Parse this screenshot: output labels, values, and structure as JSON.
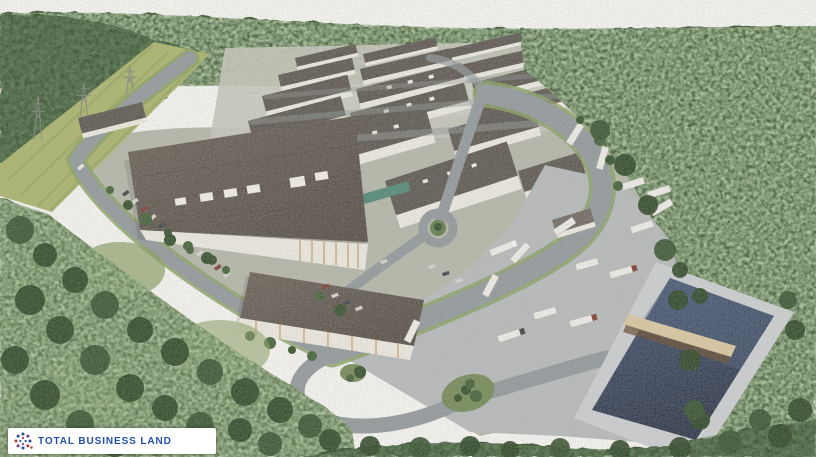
{
  "logo": {
    "text": "TOTAL BUSINESS LAND",
    "icon": "dotted-circle-logo-icon",
    "text_color": "#2450a8",
    "background": "#ffffff"
  },
  "scene": {
    "type": "aerial-architectural-rendering-of-industrial-business-park",
    "palette": {
      "sky": "#fbfbf8",
      "forest_dark": "#2e4a28",
      "forest_mid": "#3d5c33",
      "meadow": "#a9b469",
      "grass": "#6f8752",
      "road": "#8f979c",
      "apron": "#b7bbbe",
      "roof_dark": "#57524c",
      "wall_white": "#f0eee6",
      "water": "#2b3850",
      "bridge_tan": "#dcc9a2",
      "timber": "#c9a061",
      "logo_text": "#2450a8"
    }
  }
}
